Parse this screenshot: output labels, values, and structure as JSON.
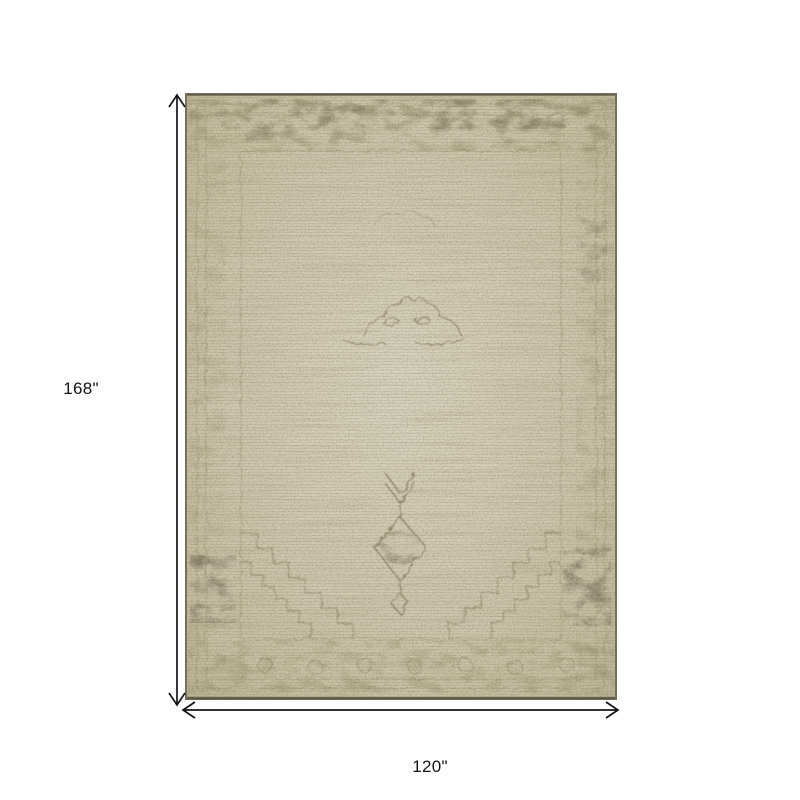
{
  "diagram": {
    "height_label": "168\"",
    "width_label": "120\"",
    "arrow_color": "#141414",
    "label_color": "#141414",
    "background_color": "#ffffff"
  },
  "rug": {
    "description": "distressed vintage medallion rug",
    "field_color": "#cdc7ac",
    "field_light_color": "#d8d3bd",
    "border_band_color": "#8f8767",
    "motif_color": "#837b5e",
    "dark_accent_color": "#5f5844",
    "edge_color": "#6b6450"
  }
}
